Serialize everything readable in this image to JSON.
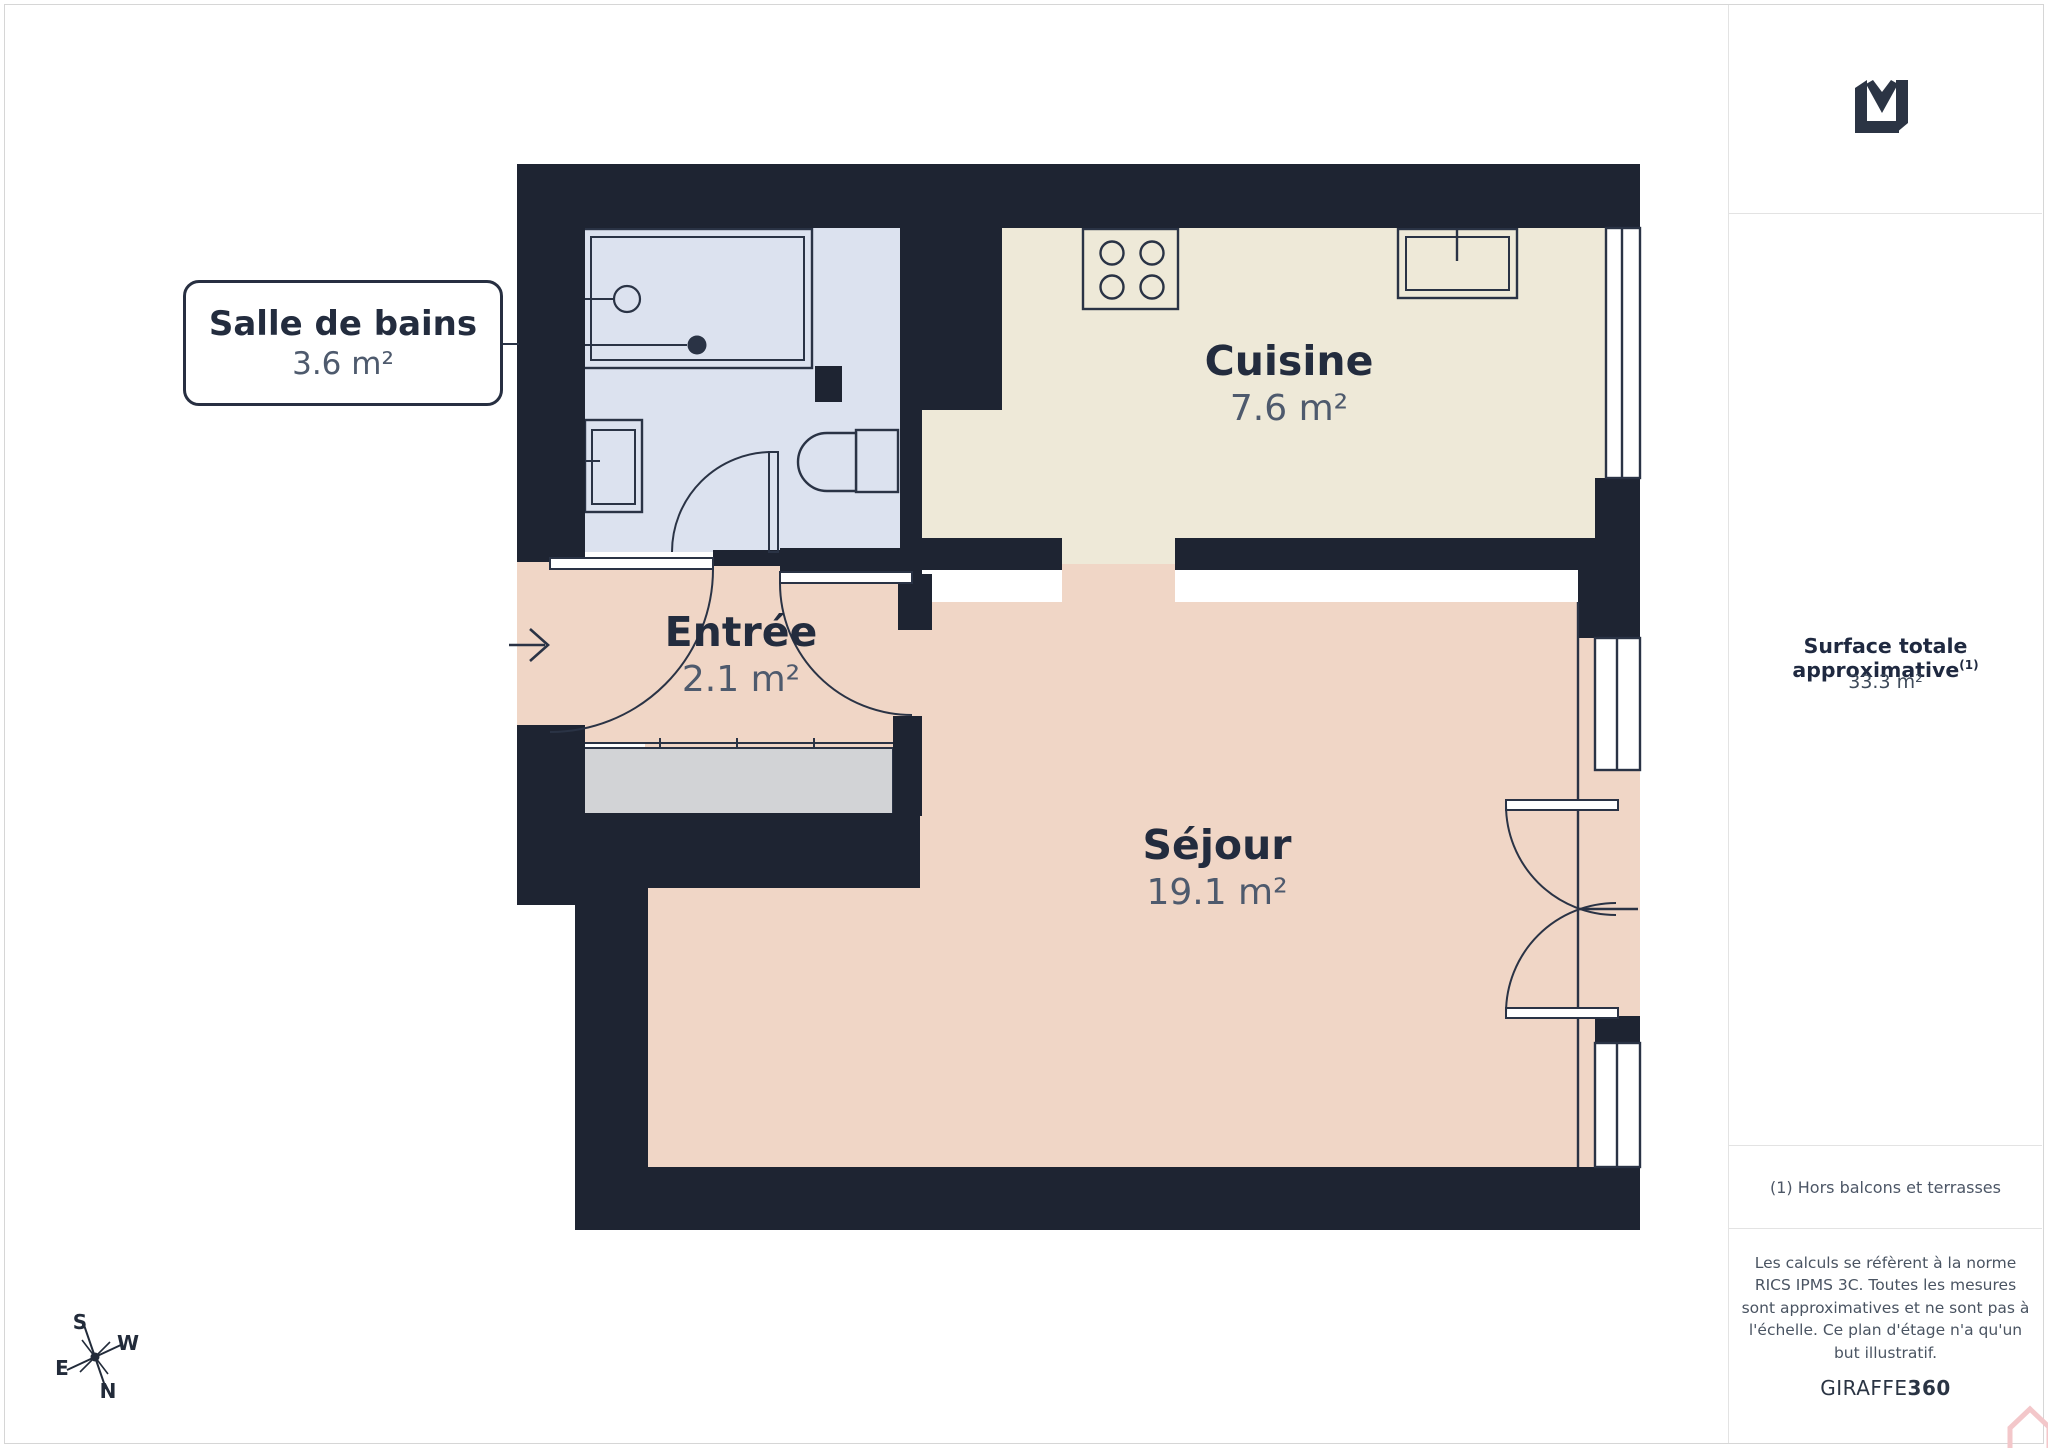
{
  "floorplan": {
    "rooms": [
      {
        "id": "salle-de-bains",
        "name": "Salle de bains",
        "area": "3.6 m²"
      },
      {
        "id": "cuisine",
        "name": "Cuisine",
        "area": "7.6 m²"
      },
      {
        "id": "entree",
        "name": "Entrée",
        "area": "2.1 m²"
      },
      {
        "id": "sejour",
        "name": "Séjour",
        "area": "19.1 m²"
      }
    ],
    "compass": {
      "n": "N",
      "s": "S",
      "e": "E",
      "w": "W"
    },
    "icons": [
      "entry-arrow",
      "compass-rose",
      "bathtub",
      "bathroom-sink",
      "toilet",
      "stove",
      "kitchen-sink",
      "wardrobe",
      "window",
      "door-swing"
    ]
  },
  "sidebar": {
    "surface_title": "Surface totale approximative",
    "surface_sup": "(1)",
    "surface_value": "33.3 m²",
    "footnote": "(1) Hors balcons et terrasses",
    "disclaimer": "Les calculs se réfèrent à la norme RICS IPMS 3C. Toutes les mesures sont approximatives et ne sont pas à l'échelle. Ce plan d'étage n'a qu'un but illustratif.",
    "brand": "GIRAFFE",
    "brand_bold": "360"
  },
  "colors": {
    "wall": "#1e2432",
    "bathroom_floor": "#dce2ef",
    "kitchen_floor": "#eee9d8",
    "living_floor": "#f0d6c6",
    "closet": "#d2d3d6",
    "fixture_stroke": "#2a3345",
    "accent_pink": "#f3c7ca",
    "divider": "#e3e3e3"
  }
}
